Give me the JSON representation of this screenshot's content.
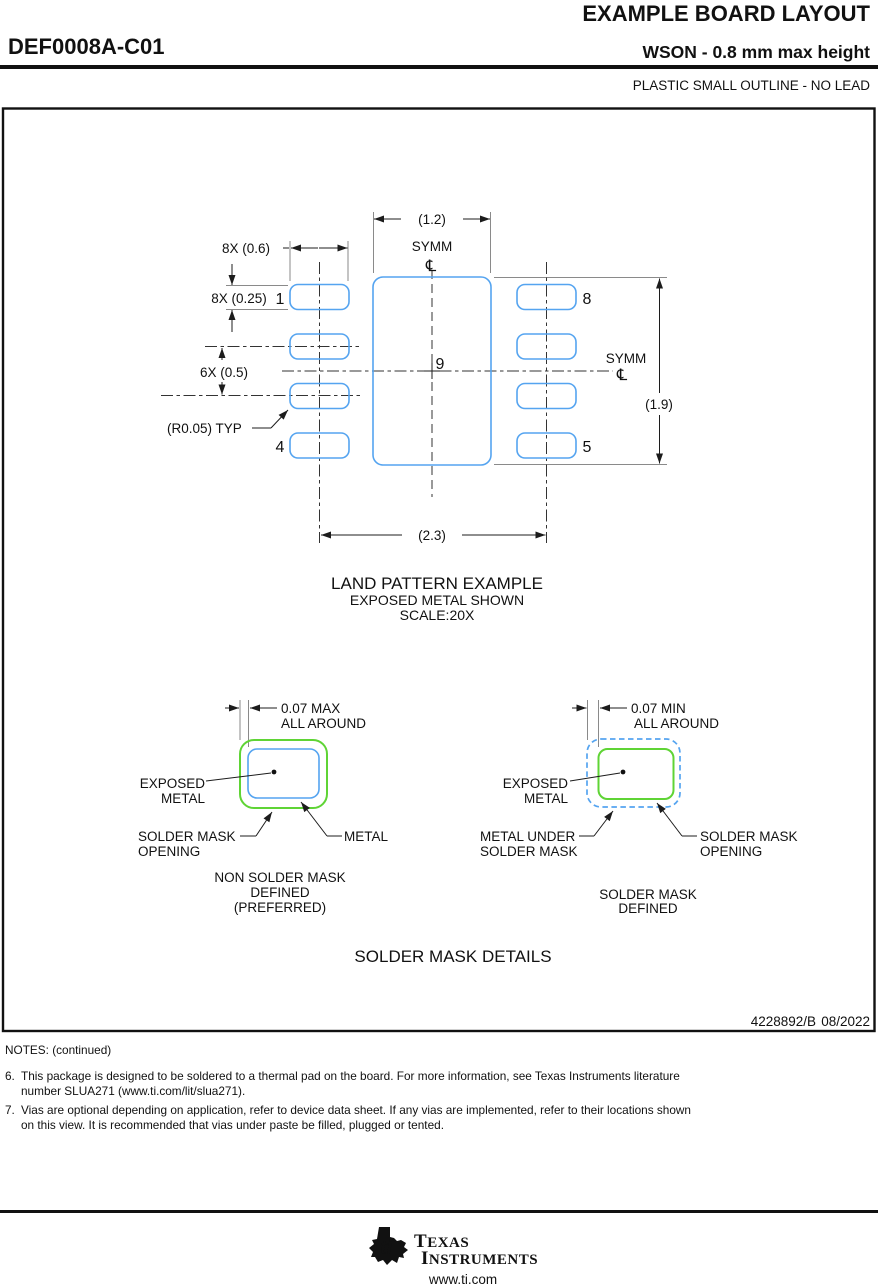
{
  "header": {
    "doc_title": "EXAMPLE BOARD LAYOUT",
    "part_number": "DEF0008A-C01",
    "package_title": "WSON - 0.8 mm max height",
    "package_subtitle": "PLASTIC SMALL OUTLINE - NO LEAD"
  },
  "land": {
    "dim_center_width": "(1.2)",
    "symm_top": "SYMM",
    "symm_right": "SYMM",
    "centerline_symbol": "℄",
    "dim_pad_width": "8X (0.6)",
    "dim_pad_height": "8X (0.25)",
    "dim_pitch": "6X (0.5)",
    "dim_radius": "(R0.05) TYP",
    "dim_center_height": "(1.9)",
    "dim_row_span": "(2.3)",
    "pin1": "1",
    "pin4": "4",
    "pin5": "5",
    "pin8": "8",
    "pin9": "9",
    "title": "LAND PATTERN EXAMPLE",
    "subtitle1": "EXPOSED METAL SHOWN",
    "subtitle2": "SCALE:20X"
  },
  "solder_mask": {
    "title": "SOLDER MASK DETAILS",
    "nsmd": {
      "dim1": "0.07 MAX",
      "dim2": "ALL AROUND",
      "exposed1": "EXPOSED",
      "exposed2": "METAL",
      "opening1": "SOLDER MASK",
      "opening2": "OPENING",
      "metal": "METAL",
      "caption1": "NON SOLDER MASK",
      "caption2": "DEFINED",
      "caption3": "(PREFERRED)"
    },
    "smd": {
      "dim1": "0.07 MIN",
      "dim2": "ALL AROUND",
      "exposed1": "EXPOSED",
      "exposed2": "METAL",
      "under1": "METAL UNDER",
      "under2": "SOLDER MASK",
      "opening1": "SOLDER MASK",
      "opening2": "OPENING",
      "caption1": "SOLDER MASK",
      "caption2": "DEFINED"
    }
  },
  "title_block": {
    "doc_number": "4228892/B",
    "date": "08/2022"
  },
  "notes": {
    "heading": "NOTES: (continued)",
    "note6_num": "6.",
    "note6_line1": "This package is designed to be soldered to a thermal pad on the board. For more information, see Texas Instruments literature",
    "note6_line2": "number SLUA271 (www.ti.com/lit/slua271).",
    "note7_num": "7.",
    "note7_line1": "Vias are optional depending on application, refer to device data sheet. If any vias are implemented, refer to their locations shown",
    "note7_line2": "on this view. It is recommended that vias under paste be filled, plugged or tented."
  },
  "footer": {
    "logo_monogram": "ti",
    "brand1": "TEXAS",
    "brand2": "INSTRUMENTS",
    "url": "www.ti.com"
  },
  "colors": {
    "pad_blue": "#55a4f0",
    "mask_green": "#5fd435",
    "line_dark": "#1c1c1c",
    "line_gray": "#8a8a8a"
  }
}
